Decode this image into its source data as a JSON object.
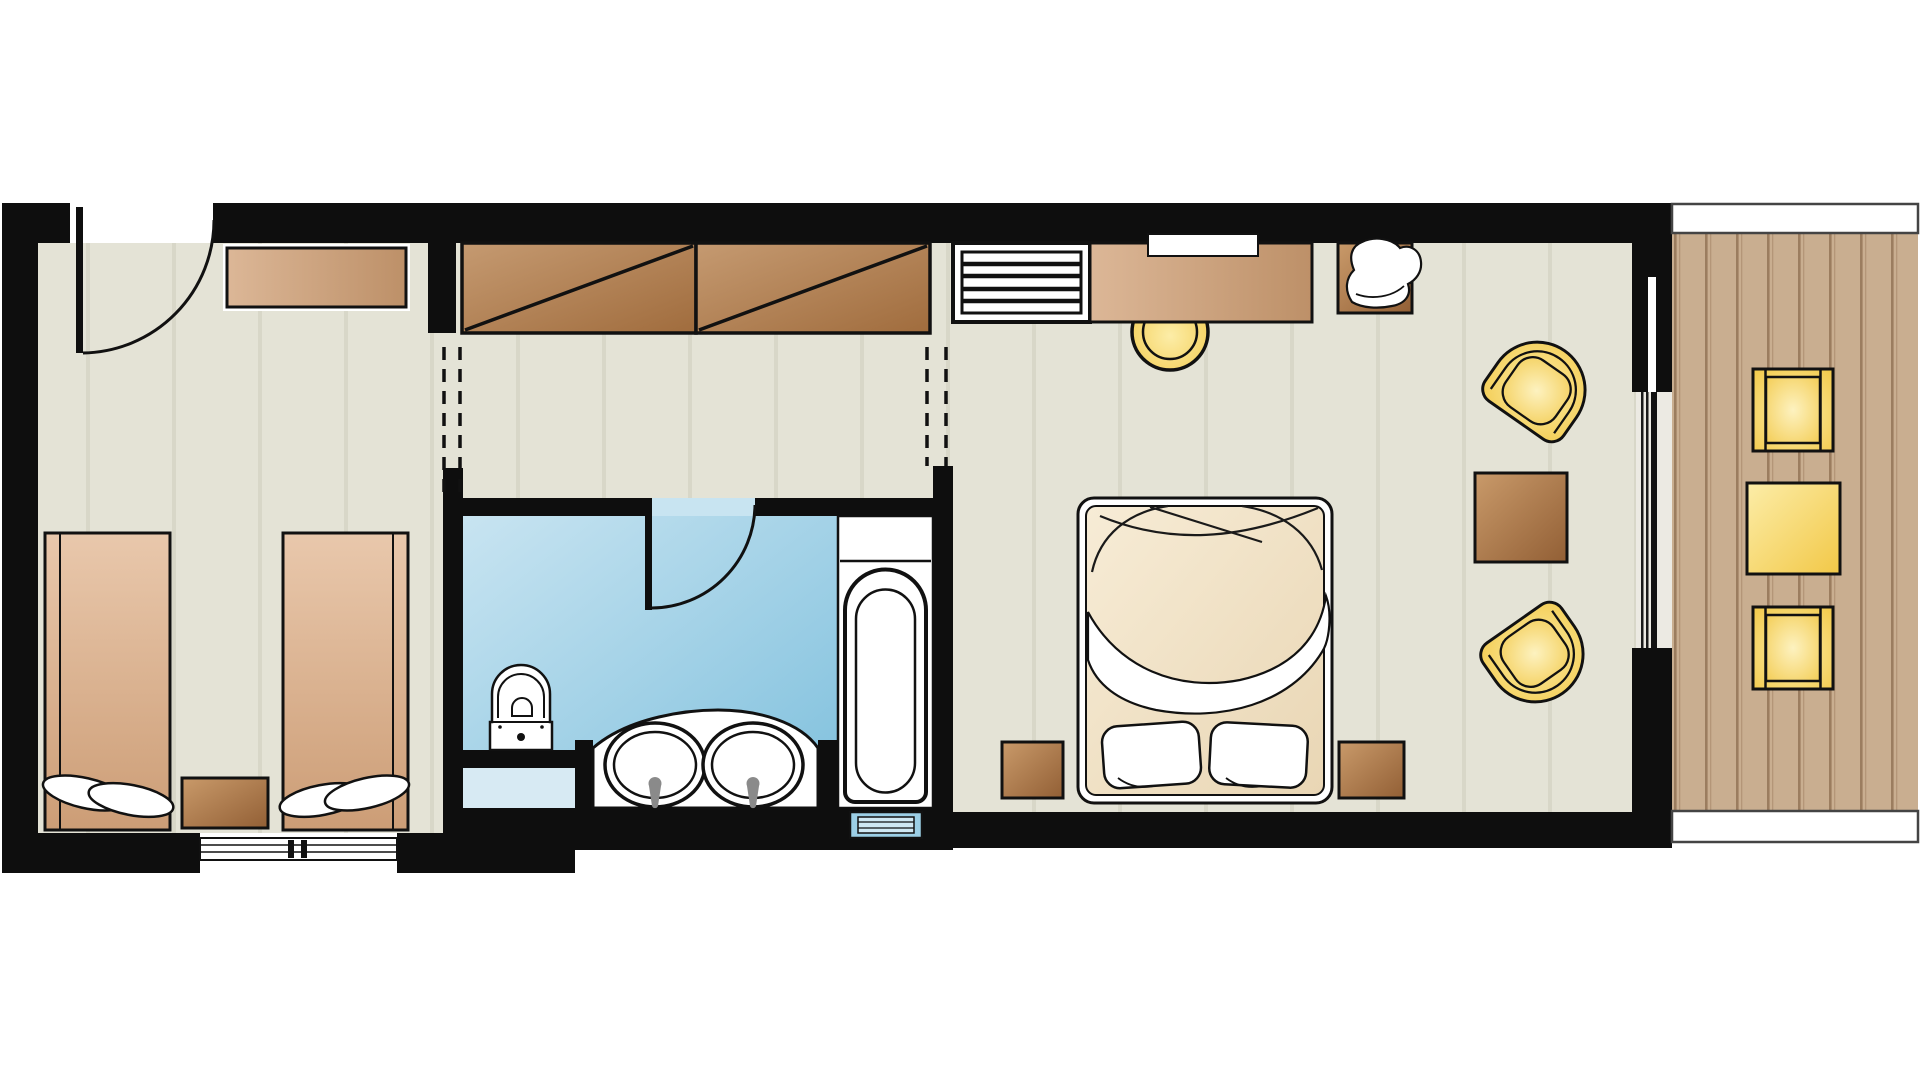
{
  "page": {
    "kind": "floor-plan",
    "background": "#ffffff",
    "visible_text": ""
  },
  "colors": {
    "wall": "#0e0e0e",
    "outline": "#111111",
    "white": "#ffffff",
    "floor": "#e4e3d6",
    "floor-stripe": "#d8d7c8",
    "bath-from": "#c8e4f1",
    "bath-to": "#7fc0dd",
    "bath-pale": "#d7eaf3",
    "bath-step": "#9ccfe6",
    "wood-from": "#dcb797",
    "wood-to": "#bd9068",
    "square-from": "#c99a6a",
    "square-to": "#925f35",
    "wardrobe-from": "#c59a71",
    "wardrobe-to": "#a06c3d",
    "twin-from": "#e9c8ac",
    "twin-to": "#cc9d76",
    "duvet-from": "#f7ecd6",
    "duvet-to": "#e9d6b4",
    "yellow-from": "#fceda8",
    "yellow-to": "#f2c847",
    "deck": "#c9ae90",
    "deck-line": "#9b7d5f",
    "deck-line2": "#b49678",
    "faucet": "#8a8a8a"
  },
  "plan": {
    "rooms": [
      {
        "id": "twin-bedroom",
        "items": [
          "entry-door",
          "wall-console",
          "twin-bed-left",
          "twin-bed-right",
          "bedside-table",
          "sliding-window"
        ]
      },
      {
        "id": "hallway",
        "items": [
          "wardrobe-panel-left",
          "wardrobe-panel-right",
          "dashed-opening-left",
          "dashed-opening-right"
        ]
      },
      {
        "id": "bathroom",
        "items": [
          "bathroom-door",
          "toilet",
          "vanity-counter",
          "sink-left",
          "sink-right",
          "bathtub",
          "bath-step"
        ]
      },
      {
        "id": "master-bedroom",
        "items": [
          "luggage-rack",
          "console-desk",
          "tv-niche",
          "stool",
          "corner-armchair",
          "double-bed",
          "pillow-left",
          "pillow-right",
          "nightstand-left",
          "nightstand-right",
          "tub-chair-top",
          "coffee-table",
          "tub-chair-bottom",
          "sliding-glass-door"
        ]
      },
      {
        "id": "balcony",
        "items": [
          "railing-top",
          "wood-deck",
          "balcony-chair-top",
          "balcony-table",
          "balcony-chair-bottom",
          "railing-bottom"
        ]
      }
    ]
  }
}
